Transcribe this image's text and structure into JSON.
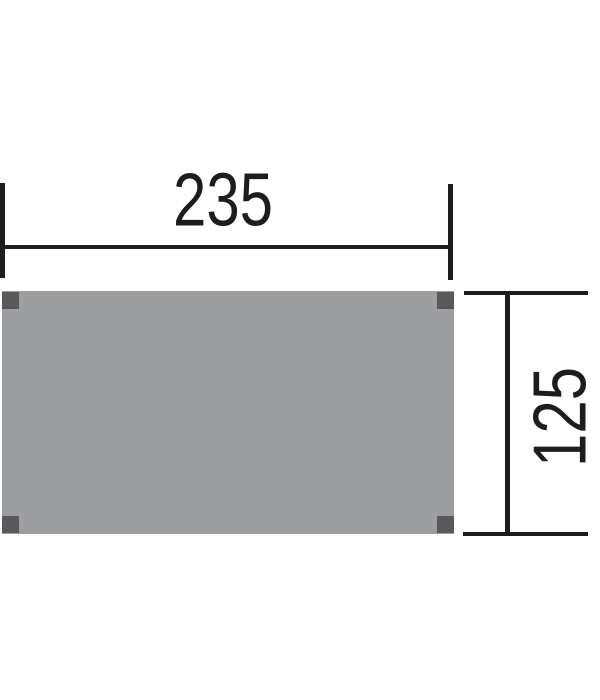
{
  "diagram": {
    "description": "floor-panel-dimension-drawing",
    "dimensions": {
      "width_label": "235",
      "height_label": "125"
    },
    "colors": {
      "line_color": "#1d1d1b",
      "panel_fill": "#9d9ea0",
      "post_fill": "#59595b",
      "background": "#ffffff"
    }
  }
}
